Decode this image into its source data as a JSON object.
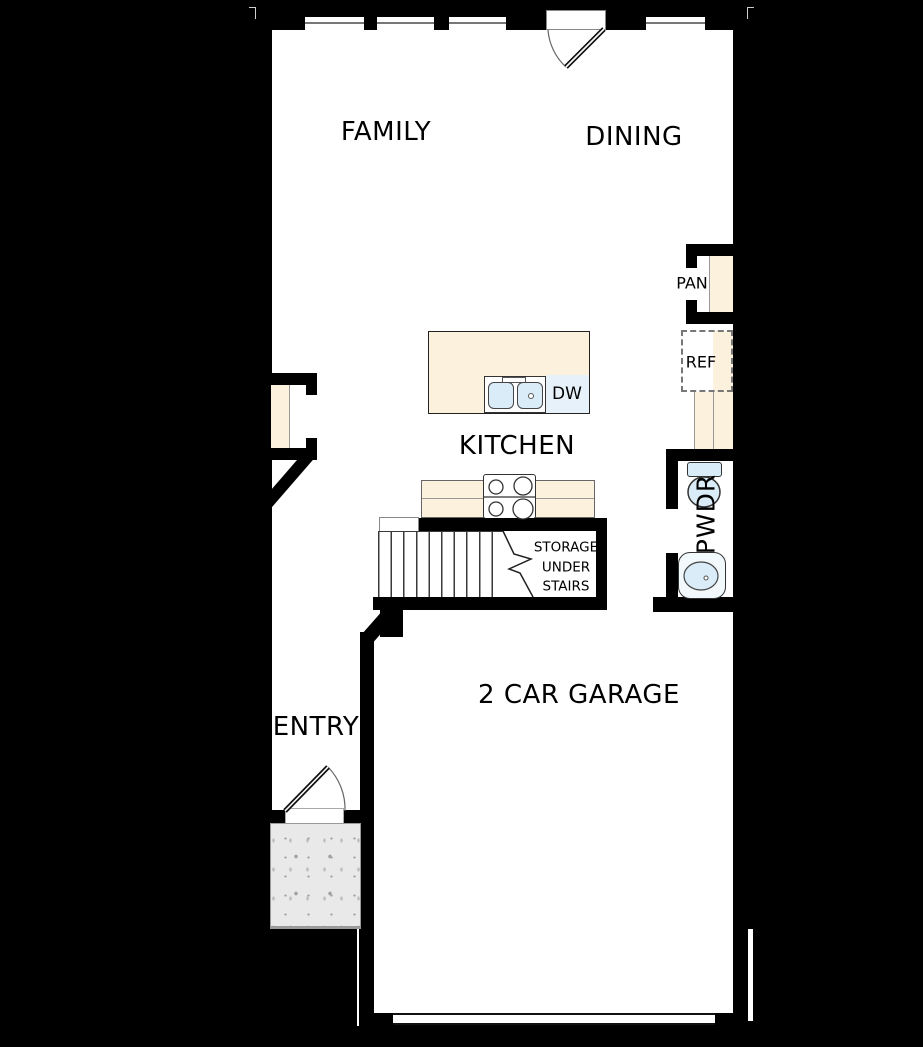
{
  "colors": {
    "background": "#000000",
    "wall": "#000000",
    "floor": "#ffffff",
    "cabinet_cream": "#fbf1dd",
    "fixture_blue": "#d9ecf7",
    "dishwasher_blue": "#e7f1f9",
    "porch_gray": "#e9e9e9"
  },
  "rooms": {
    "family": {
      "label": "FAMILY"
    },
    "dining": {
      "label": "DINING"
    },
    "kitchen": {
      "label": "KITCHEN"
    },
    "entry": {
      "label": "ENTRY"
    },
    "garage": {
      "label": "2 CAR GARAGE"
    },
    "pantry": {
      "label": "PAN"
    },
    "powder": {
      "label": "PWDR"
    }
  },
  "fixtures": {
    "refrigerator": {
      "label": "REF"
    },
    "dishwasher": {
      "label": "DW"
    }
  },
  "storage_note": [
    "STORAGE",
    "UNDER",
    "STAIRS"
  ]
}
